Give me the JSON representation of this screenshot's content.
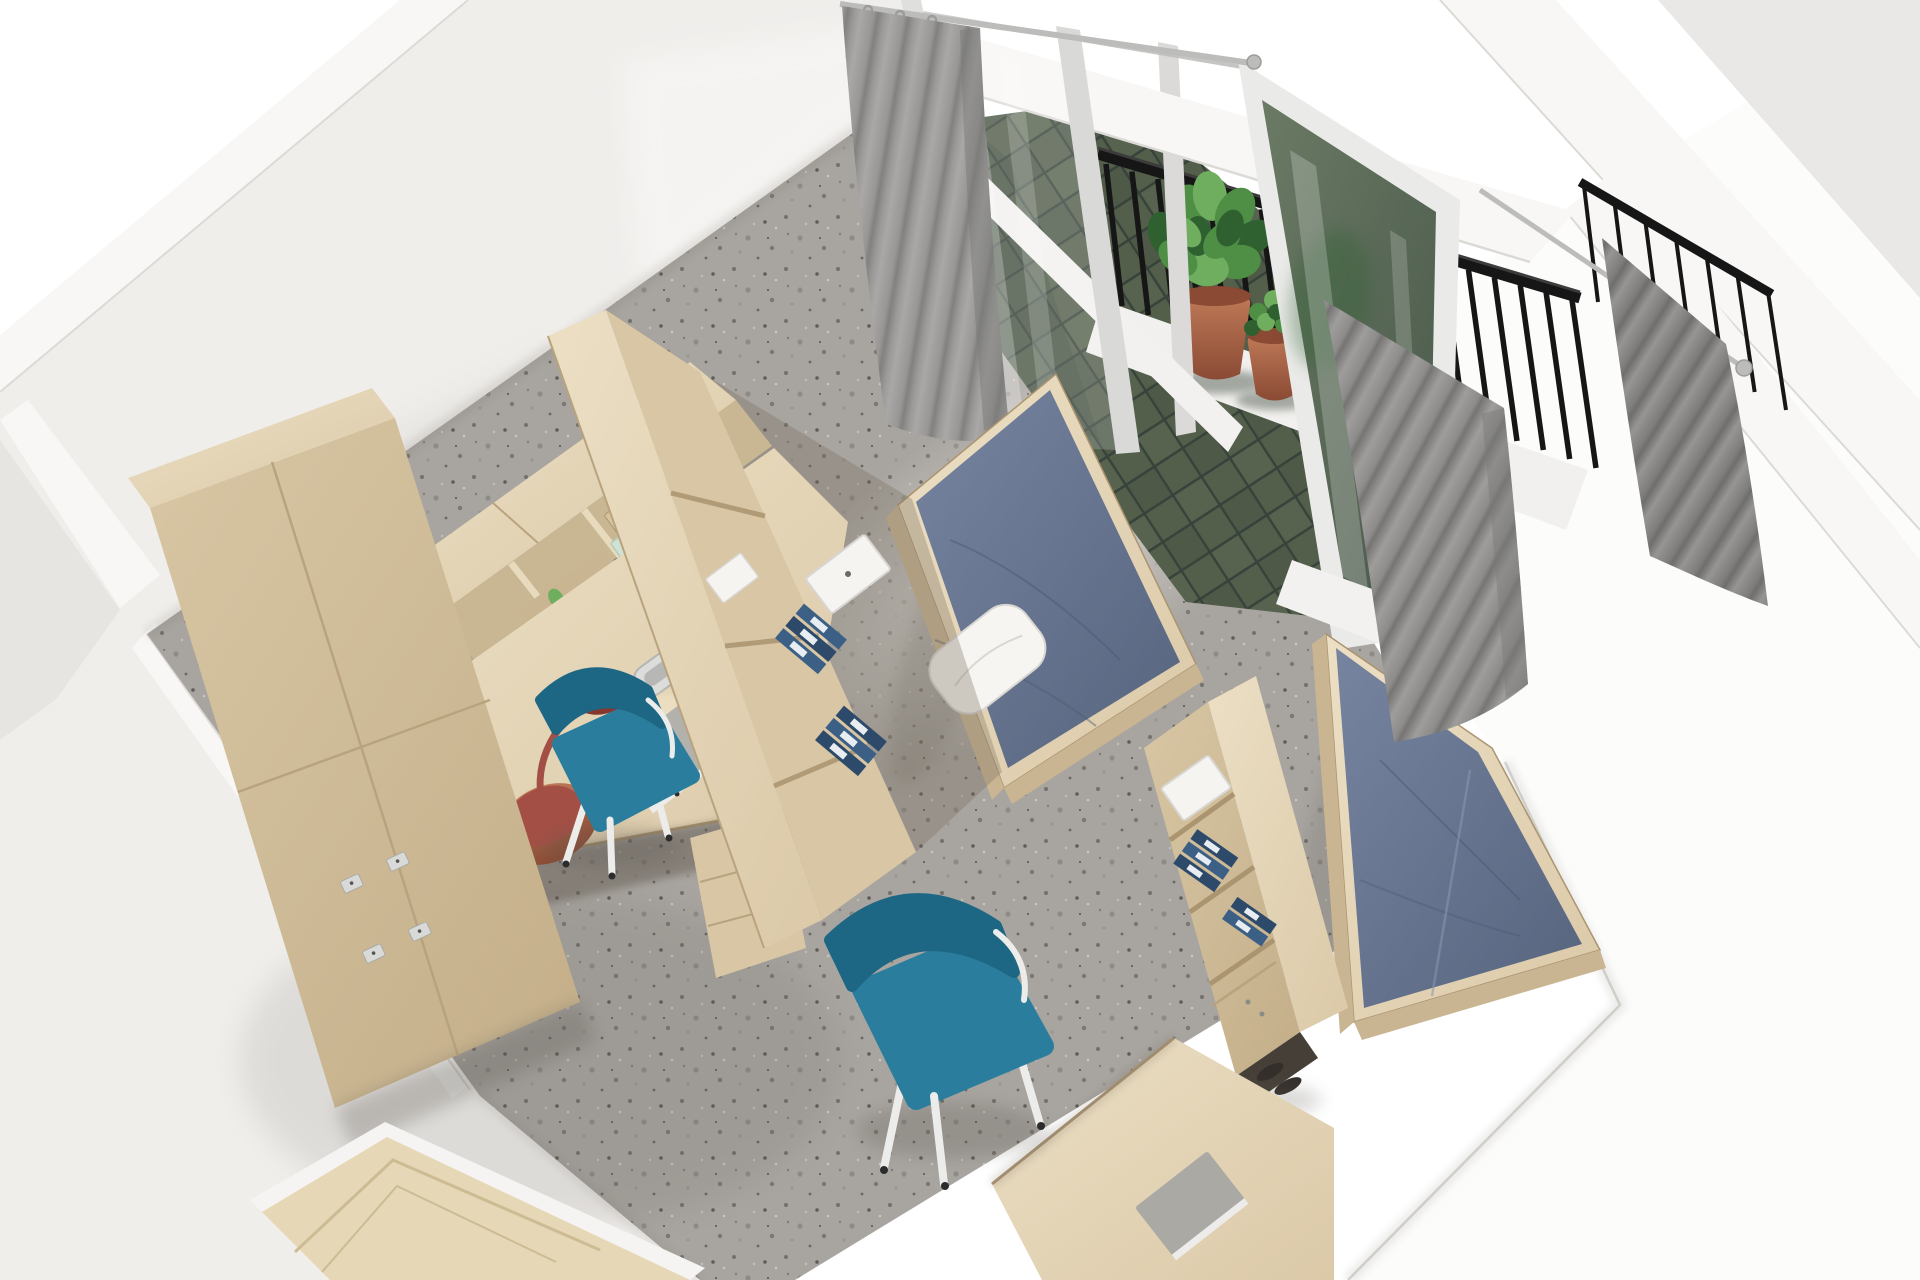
{
  "meta": {
    "title": "Dormitory room – bird's-eye 3D render",
    "render_type": "photorealistic 3D architectural cutaway, top-down oblique view",
    "room": "twin student dorm room with balcony"
  },
  "scene": {
    "objects": [
      "white-cutaway-walls",
      "terrazzo-floor",
      "entrance-door",
      "wardrobe-lockers",
      "corner-desk-with-hutch",
      "tall-bookshelf-partition-1",
      "desk-lamp",
      "notebook-and-pen",
      "cable-grommet",
      "desk-chair-1",
      "bed-1-blue-mattress",
      "pillow",
      "balcony",
      "balcony-green-tile-floor",
      "balcony-black-railing",
      "potted-plant-large",
      "potted-plant-small",
      "sliding-glass-door",
      "window-over-bed-2",
      "curtain-left",
      "curtain-over-bed-2",
      "curtain-far-right",
      "curtain-rods",
      "bed-2-blue-mattress",
      "bookshelf-partition-2",
      "desk-2",
      "desk-chair-2",
      "binders-and-boxes",
      "shoes"
    ],
    "balcony": {
      "main_railing_bars": 19,
      "far_railing_bars": 7
    }
  },
  "palette": {
    "background": "#ffffff",
    "wall_face": "#f0eeeb",
    "wall_face_dark": "#e7e5e2",
    "wall_bright": "#f8f7f5",
    "wall_edge": "#dcdad6",
    "exterior_white": "#fcfcfb",
    "ext_gray_face": "#e9e8e6",
    "floor_base": "#a8a49f",
    "speckle_dark": "#5f5b56",
    "speckle_mid": "#807c77",
    "speckle_light": "#c9c5c0",
    "balcony_tile": "#535e4b",
    "balcony_tile_dark": "#3f4a3c",
    "balcony_grout": "#36423a",
    "threshold_white": "#f2f1ef",
    "parapet_white": "#f1f0ee",
    "wood_top": "#e7dabd",
    "wood_mid": "#d8c6a4",
    "wood_front": "#cab593",
    "wood_dark": "#b9a27c",
    "wood_edge": "#ab9470",
    "wood_seam": "#b8a37e",
    "cubby_bg": "#c9b794",
    "door_wood": "#e6d7b6",
    "door_line": "#cdbb94",
    "door_frame_white": "#f5f4f2",
    "mattress_base": "#66748e",
    "mattress_crease": "#4d5a73",
    "mattress_fold": "#8b97ae",
    "pillow_white": "#f6f5f1",
    "pillow_shade": "#d9d7d2",
    "curtain_base": "#989795",
    "curtain_fold": "#7a7977",
    "rod_silver": "#bcbcba",
    "rod_dark": "#9c9c9a",
    "railing_black": "#161616",
    "railing_high": "#3c3c3c",
    "glass_white": "#ffffff",
    "glass_frame": "#eaeae8",
    "glass_jamb": "#dfdfdd",
    "glass_mullion": "#d9d9d7",
    "glass_post": "#dbdad8",
    "plant_green": "#4e8f45",
    "plant_green_dark": "#2f6030",
    "plant_green_light": "#6fae5f",
    "pot_clay": "#b0674a",
    "pot_clay_dark": "#8a4a34",
    "pot_shadow": "#2e3a2e",
    "chair_teal": "#2a7d9d",
    "chair_teal_dark": "#1d6784",
    "chair_leg_white": "#ececea",
    "chair_foot_dark": "#2c2c2c",
    "lamp_red": "#a34f45",
    "lamp_red_dark": "#86372f",
    "notebook_gray": "#b3b1ac",
    "notebook_gray2": "#aba9a4",
    "page_white": "#edecea",
    "pen_light": "#dededc",
    "pen_tip": "#2e2e2e",
    "binder_blue": "#3c5f86",
    "binder_navy": "#2e4a6b",
    "binder_label_white": "#e8edf2",
    "binder_label_green": "#3f8f4f",
    "box_white": "#f5f4f1",
    "box_white_edge": "#d8d6d2",
    "box_mint": "#cfe2d3",
    "box_wood": "#d8c49c",
    "plate_silver": "#d9d9d7",
    "plate_edge": "#a9a9a7",
    "shoe_dark": "#332e29",
    "ao_dark": "#5f5a52"
  }
}
